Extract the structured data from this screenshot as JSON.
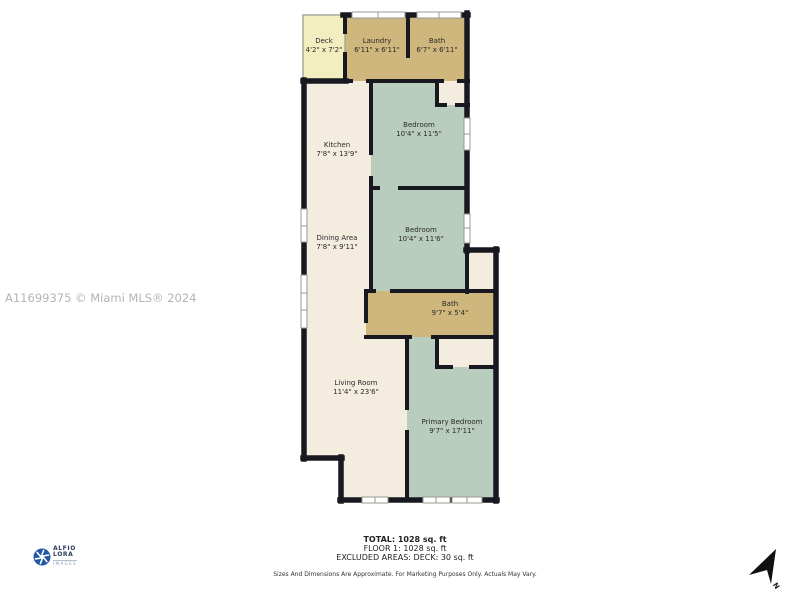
{
  "watermark": "A11699375 © Miami MLS® 2024",
  "logo": {
    "line1": "ALFIO",
    "line2": "LORA",
    "line3": "IMAGES"
  },
  "compass": {
    "label": "N"
  },
  "rooms": [
    {
      "name": "Deck",
      "dims": "4'2\" x 7'2\""
    },
    {
      "name": "Laundry",
      "dims": "6'11\" x 6'11\""
    },
    {
      "name": "Bath",
      "dims": "6'7\" x 6'11\""
    },
    {
      "name": "Kitchen",
      "dims": "7'8\" x 13'9\""
    },
    {
      "name": "Bedroom",
      "dims": "10'4\" x 11'5\""
    },
    {
      "name": "Bedroom",
      "dims": "10'4\" x 11'6\""
    },
    {
      "name": "Dining Area",
      "dims": "7'8\" x 9'11\""
    },
    {
      "name": "Bath",
      "dims": "9'7\" x 5'4\""
    },
    {
      "name": "Living Room",
      "dims": "11'4\" x 23'6\""
    },
    {
      "name": "Primary Bedroom",
      "dims": "9'7\" x 17'11\""
    }
  ],
  "summary": {
    "total": "TOTAL: 1028 sq. ft",
    "floor1": "FLOOR 1: 1028 sq. ft",
    "excluded": "EXCLUDED AREAS: DECK: 30 sq. ft",
    "disclaimer": "Sizes And Dimensions Are Approximate. For Marketing Purposes Only. Actuals May Vary."
  },
  "colors": {
    "wall": "#181820",
    "cream": "#f3ecdf",
    "sage": "#b8cdbe",
    "tan": "#cfb67c",
    "deck": "#f3eec0",
    "frame": "#9a9a94",
    "watermark": "#b4b4b4",
    "logoBlue": "#2257a5",
    "text": "#222222"
  }
}
